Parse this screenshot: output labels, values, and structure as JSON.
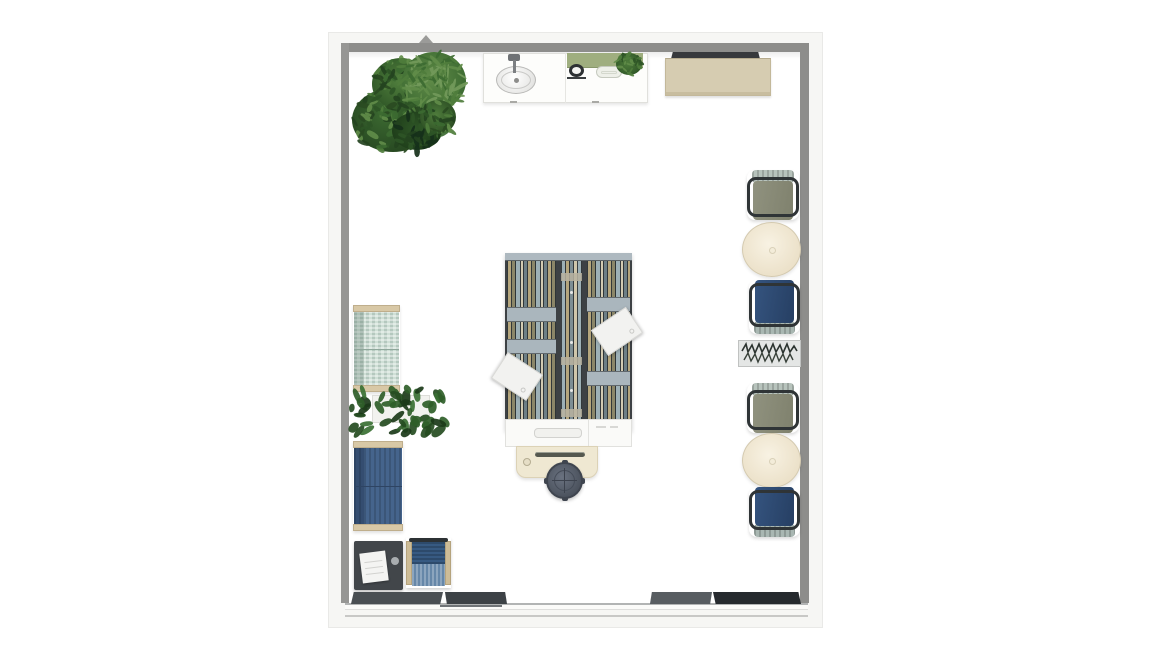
{
  "view": {
    "kind": "floor-plan-top-view",
    "background_color": "#ffffff",
    "visible_text": []
  },
  "room": {
    "wall_color": "#8d8d8b",
    "outer_frame_color": "#f6f6f4",
    "floor_color": "#ffffff",
    "walls": [
      "top",
      "left",
      "right"
    ],
    "front": {
      "type": "sliding-glass-door-wall",
      "panel_count": 4,
      "panel_colors": [
        "#4a4f53",
        "#3d4246",
        "#585d61",
        "#262a2e"
      ]
    }
  },
  "furniture": {
    "top_wall": [
      {
        "name": "large-potted-plant",
        "kind": "plant",
        "colors": [
          "#24431f",
          "#3c6a31",
          "#618c49"
        ]
      },
      {
        "name": "sink-counter",
        "kind": "counter",
        "color": "#fdfdfb",
        "features": [
          "oval-sink",
          "faucet"
        ]
      },
      {
        "name": "coffee-station",
        "kind": "appliance-counter",
        "color": "#9fae7f",
        "features": [
          "7-burner-knobs",
          "kettle",
          "tray",
          "small-plant"
        ]
      },
      {
        "name": "credenza",
        "kind": "sideboard",
        "color": "#d6ccb1",
        "top_color": "#37393c"
      }
    ],
    "right_wall": [
      {
        "name": "lounge-chair-olive-1",
        "kind": "chair",
        "seat_color": "#8b8d7b",
        "back_color": "#b7c3bc"
      },
      {
        "name": "round-table-1",
        "kind": "table",
        "color": "#f1e9d6"
      },
      {
        "name": "lounge-chair-navy-1",
        "kind": "chair",
        "seat_color": "#2e4c77",
        "back_color": "#a9b7b2"
      },
      {
        "name": "scribble-wall-art",
        "kind": "decor",
        "color": "#e4e6e5",
        "mark_color": "#2c3430"
      },
      {
        "name": "lounge-chair-olive-2",
        "kind": "chair",
        "seat_color": "#8b8d7b",
        "back_color": "#b7c3bc"
      },
      {
        "name": "round-table-2",
        "kind": "table",
        "color": "#f1e9d6"
      },
      {
        "name": "lounge-chair-navy-2",
        "kind": "chair",
        "seat_color": "#2e4c77",
        "back_color": "#a9b7b2"
      }
    ],
    "center": [
      {
        "name": "double-sided-bookshelf",
        "kind": "shelving",
        "frame_color": "#3d4144",
        "shelf_color": "#aab6bd",
        "book_colors": [
          "#b5a67d",
          "#8b8668",
          "#9db0b6",
          "#d3cbb2",
          "#6d7f86"
        ]
      },
      {
        "name": "paper-sheet-1",
        "kind": "document",
        "color": "#f2f2f0"
      },
      {
        "name": "paper-sheet-2",
        "kind": "document",
        "color": "#f2f2f0"
      },
      {
        "name": "drawer-unit",
        "kind": "storage",
        "color": "#fafaf8"
      },
      {
        "name": "writing-desk",
        "kind": "desk",
        "color": "#efe8d2"
      },
      {
        "name": "office-stool",
        "kind": "stool",
        "color": "#5b6370"
      }
    ],
    "left_wall": [
      {
        "name": "loveseat-sage",
        "kind": "sofa",
        "color": "#cfdfd6",
        "trim_color": "#d8c8a6"
      },
      {
        "name": "vine-planter",
        "kind": "plant",
        "colors": [
          "#1b3a19",
          "#2f5e29"
        ],
        "box_color": "#f2f2ef"
      },
      {
        "name": "loveseat-navy",
        "kind": "sofa",
        "color": "#45648c",
        "trim_color": "#d8c8a6"
      },
      {
        "name": "side-table-black",
        "kind": "table",
        "color": "#42464a",
        "items": [
          "notepad",
          "cup"
        ]
      },
      {
        "name": "armchair-navy",
        "kind": "chair",
        "color": "#375a82",
        "trim_color": "#cdbc97"
      }
    ]
  }
}
